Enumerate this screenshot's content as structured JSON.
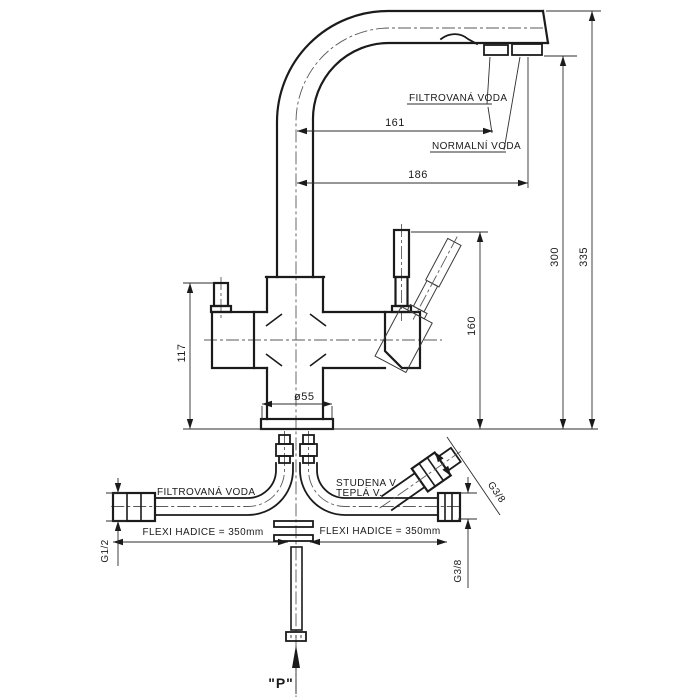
{
  "drawing": {
    "labels": {
      "filtered_water_top": "FILTROVANÁ VODA",
      "normal_water": "NORMALNÍ VODA",
      "filtered_water_hose": "FILTROVANÁ VODA",
      "cold_water": "STUDENA V.",
      "hot_water": "TEPLÁ V.",
      "flexi_hose_left": "FLEXI HADICE = 350mm",
      "flexi_hose_right": "FLEXI HADICE = 350mm",
      "pressure_mark": "\"P\""
    },
    "dimensions": {
      "spout_filtered_reach": "161",
      "spout_normal_reach": "186",
      "spout_height": "300",
      "total_height": "335",
      "body_height": "117",
      "lever_height": "160",
      "base_diameter": "ø55",
      "thread_filtered": "G1/2",
      "thread_mix_vertical": "G3/8",
      "thread_mix_diagonal": "G3/8"
    },
    "colors": {
      "background": "#ffffff",
      "line": "#1b1b1b",
      "thin_line": "#2e2e2e",
      "centerline": "#5a5a5a"
    }
  }
}
